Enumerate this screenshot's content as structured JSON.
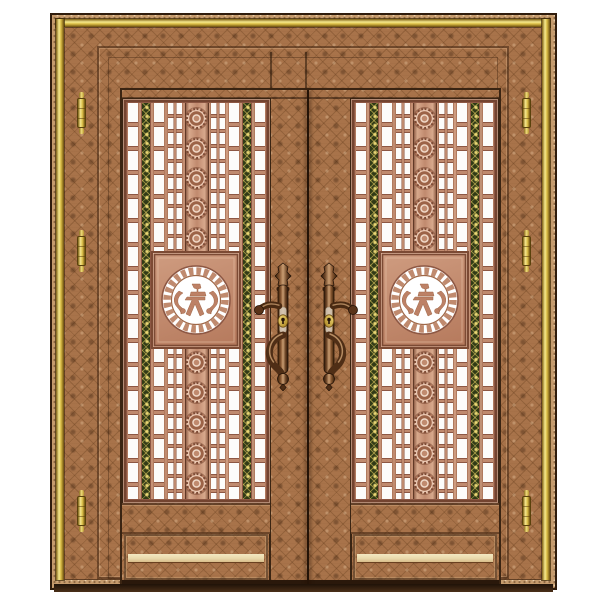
{
  "image": {
    "kind": "product photo",
    "subject": "Chinese-style bronze double security door with copper lattice panels, gold trim, fretwork medallions and cast lever handles",
    "background": "#ffffff"
  },
  "palette": {
    "page_bg": "#ffffff",
    "outline": "#2f1c0c",
    "bronze": "#a8734a",
    "bronze_motif": "#6a4020",
    "bronze_light": "#c59b6d",
    "gold_hi": "#f6e88e",
    "gold": "#d9bc45",
    "gold_dark": "#7c5e14",
    "copper": "#c08a6e",
    "copper_light": "#e2b398",
    "copper_dark": "#8d5743",
    "pane_white": "#fdfcfa",
    "green_dark": "#303a16",
    "green_gold": "#ddc75e",
    "handle_dark": "#4f2e16",
    "handle_mid": "#8a5a34",
    "keyhole_gold": "#e0b83f",
    "highlight_strip": "#e9d9ac",
    "threshold": "#241307"
  },
  "door": {
    "leaf_count": 2,
    "frame": {
      "material": "patterned bronze architrave",
      "trim": "polished gold bands on top and both sides"
    },
    "hinges": {
      "per_side": 3,
      "sides": [
        "left",
        "right"
      ],
      "y_positions": [
        90,
        228,
        488
      ]
    },
    "panel": {
      "columns": [
        "pane-column",
        "green-band",
        "pane-column",
        "pane-grid",
        "rosette-column",
        "pane-grid",
        "pane-column",
        "green-band",
        "pane-column"
      ],
      "rosettes_above": 5,
      "rosettes_below": 5,
      "medallion": {
        "ring": "greek-key fretwork circle",
        "center": "paper-cut figure motif on white ground"
      }
    },
    "hardware": {
      "handles": 2,
      "keyholes": 2,
      "style": "ornate cast bronze lever with scroll pull and beast-head finial"
    }
  }
}
